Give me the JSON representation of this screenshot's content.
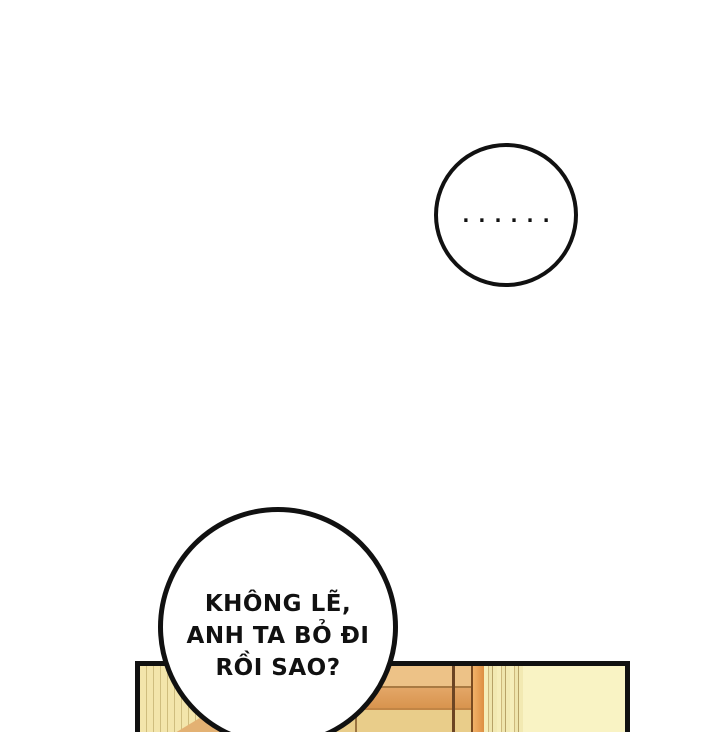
{
  "page": {
    "background_color": "#ffffff"
  },
  "dialogue": {
    "ellipsis_bubble": {
      "text": "......"
    },
    "question_bubble": {
      "lines": [
        "KHÔNG LẼ,",
        "ANH TA BỎ ĐI",
        "RỒI SAO?"
      ]
    }
  },
  "artwork_panel": {
    "outline_color": "#111111",
    "colors": {
      "wall": "#f9f3c4",
      "door": "#f3e5ab",
      "door_stripe": "#cfbd7e",
      "door_wedge": "#e3b173",
      "shelf_top": "#edc287",
      "shelf_mid": "#df9e5c",
      "shelf_bottom": "#e9cd8a",
      "shelf_divider": "#6b4423",
      "frame_strip": "#e8a258",
      "curtain": "#f6eeba",
      "curtain_fold": "#c2ae74"
    }
  }
}
